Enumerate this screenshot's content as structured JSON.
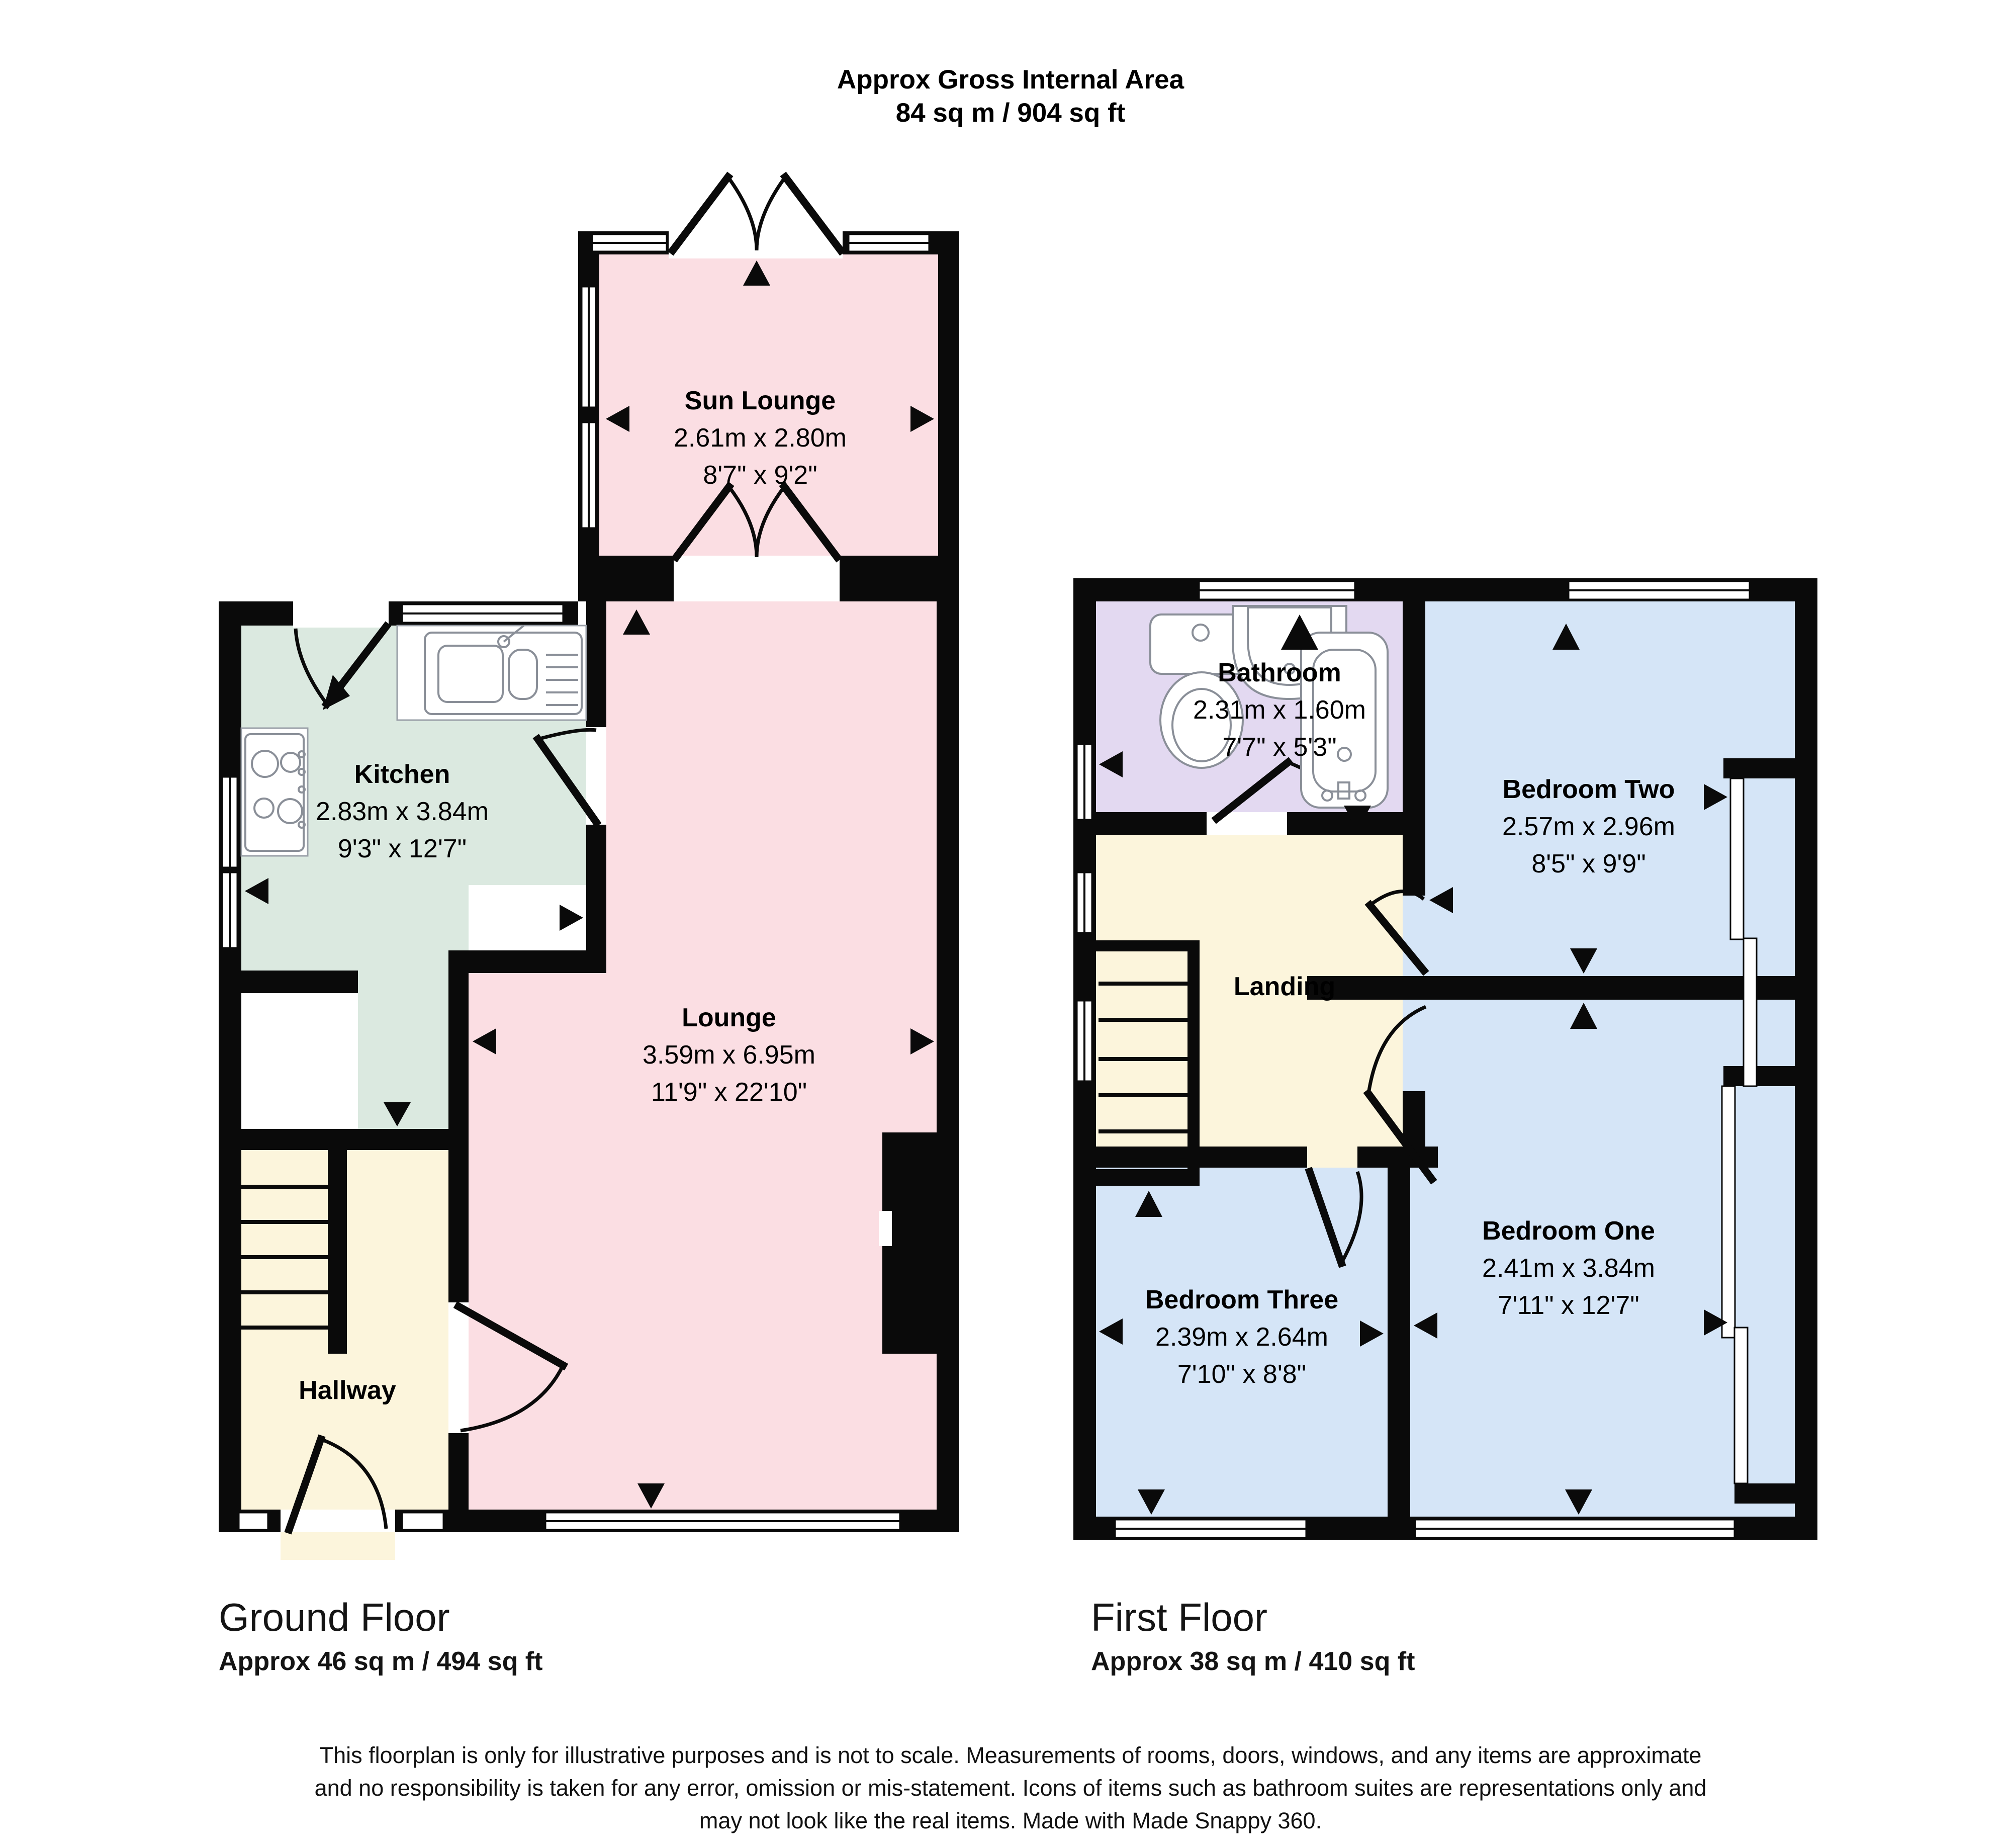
{
  "header": {
    "title_line1": "Approx Gross Internal Area",
    "title_line2": "84 sq m / 904 sq ft"
  },
  "ground_floor": {
    "label": "Ground Floor",
    "area": "Approx 46 sq m / 494 sq ft",
    "rooms": {
      "sun_lounge": {
        "name": "Sun Lounge",
        "metric": "2.61m x 2.80m",
        "imperial": "8'7\" x 9'2\""
      },
      "kitchen": {
        "name": "Kitchen",
        "metric": "2.83m x 3.84m",
        "imperial": "9'3\" x 12'7\""
      },
      "lounge": {
        "name": "Lounge",
        "metric": "3.59m x 6.95m",
        "imperial": "11'9\" x 22'10\""
      },
      "hallway": {
        "name": "Hallway"
      }
    }
  },
  "first_floor": {
    "label": "First Floor",
    "area": "Approx 38 sq m / 410 sq ft",
    "rooms": {
      "bathroom": {
        "name": "Bathroom",
        "metric": "2.31m x 1.60m",
        "imperial": "7'7\" x 5'3\""
      },
      "bedroom_two": {
        "name": "Bedroom Two",
        "metric": "2.57m x 2.96m",
        "imperial": "8'5\" x 9'9\""
      },
      "landing": {
        "name": "Landing"
      },
      "bedroom_three": {
        "name": "Bedroom Three",
        "metric": "2.39m x 2.64m",
        "imperial": "7'10\" x 8'8\""
      },
      "bedroom_one": {
        "name": "Bedroom One",
        "metric": "2.41m x 3.84m",
        "imperial": "7'11\" x 12'7\""
      }
    }
  },
  "disclaimer": {
    "line1": "This floorplan is only for illustrative purposes and is not to scale. Measurements of rooms, doors, windows, and any items are approximate",
    "line2": "and no responsibility is taken for any error, omission or mis-statement. Icons of items such as bathroom suites are representations only and",
    "line3": "may not look like the real items. Made with Made Snappy 360."
  },
  "colors": {
    "wall": "#0a0a0a",
    "pink": "#fbdee3",
    "green": "#dbe9e0",
    "cream": "#fcf5dc",
    "purple": "#e3d9f1",
    "blue": "#d5e5f7"
  }
}
